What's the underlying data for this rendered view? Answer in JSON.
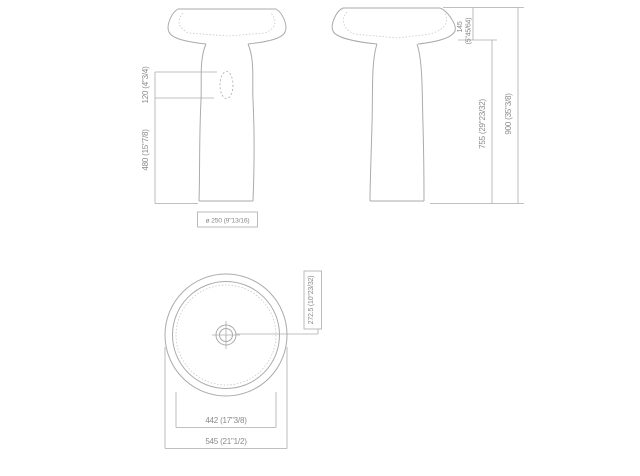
{
  "drawing": {
    "title": "pedestal-washbasin-dimension-drawing",
    "front_view": {
      "overflow_height": "120 (4\"3/4)",
      "pedestal_height": "480 (15\"7/8)",
      "pedestal_diameter": "ø 250 (9\"13/16)"
    },
    "side_view": {
      "basin_depth_mm": "145",
      "basin_depth_in": "(5\"45/64)",
      "floor_to_basin": "755 (29\"23/32)",
      "total_height": "900 (35\"3/8)"
    },
    "top_view": {
      "drain_offset": "272.5 (10\"23/32)",
      "inner_diameter": "442 (17\"3/8)",
      "outer_diameter": "545 (21\"1/2)"
    }
  },
  "colors": {
    "background": "#ffffff",
    "line": "#ababab",
    "text": "#8a8a8a"
  }
}
